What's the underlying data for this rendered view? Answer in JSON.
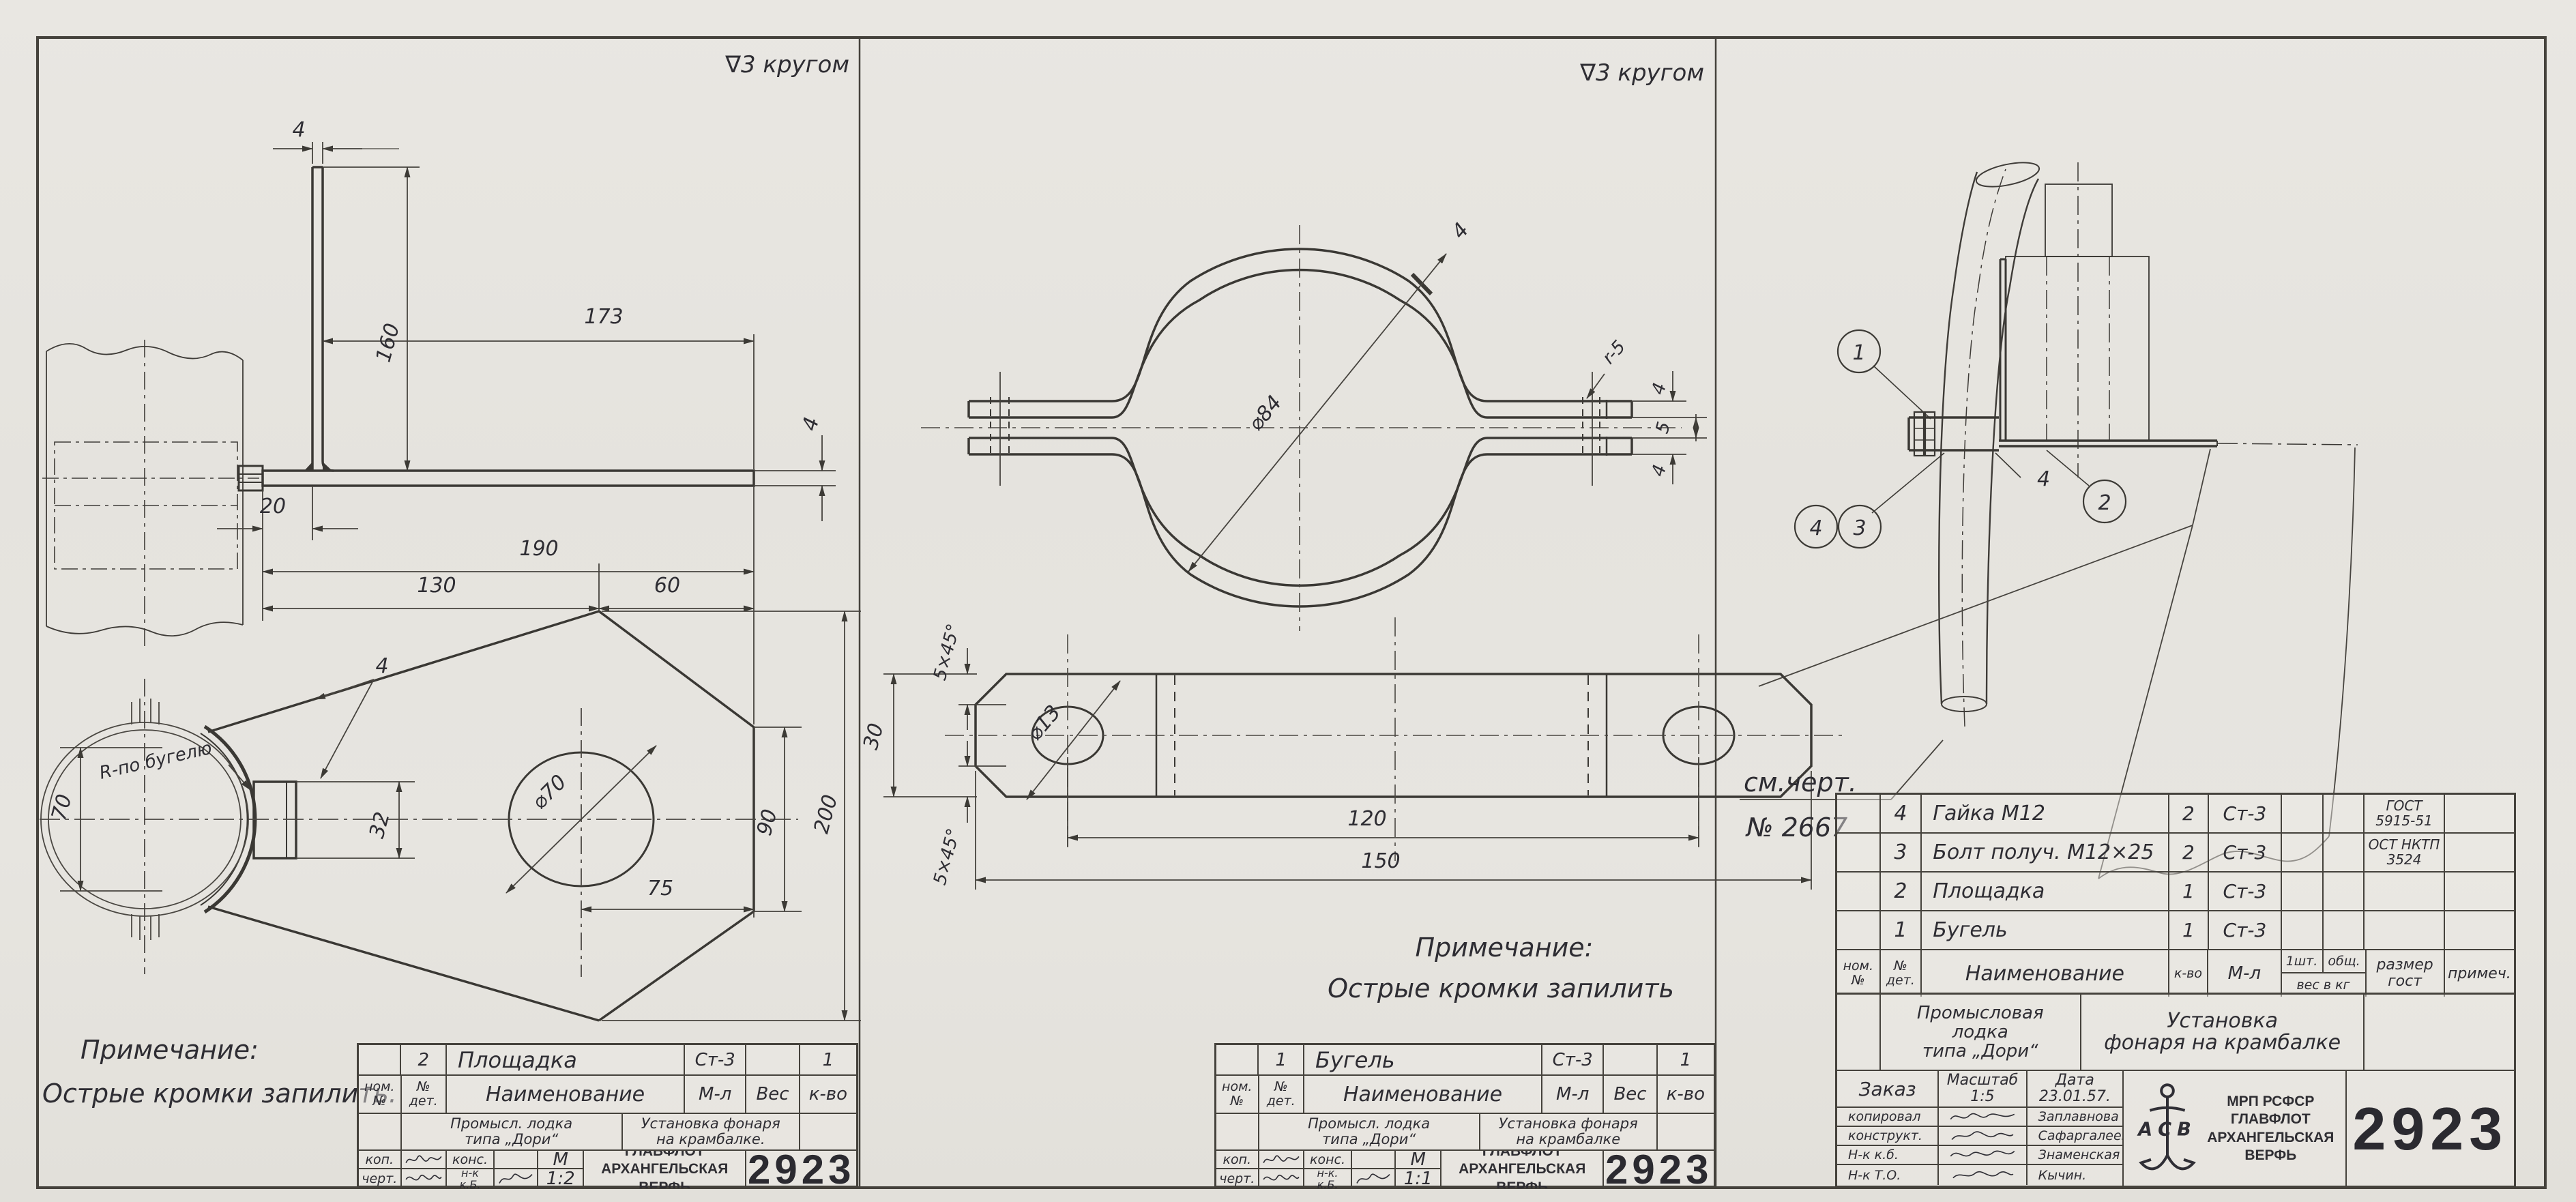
{
  "sheet": {
    "doc_number": "2923"
  },
  "panel_platform": {
    "surface_note": "∇3 кругом",
    "note_title": "Примечание:",
    "note_text": "Острые кромки запилить.",
    "dims": {
      "leg_thickness": "4",
      "leg_height": "160",
      "top_length": "173",
      "plate_thickness": "4",
      "end_offset": "20",
      "overall_length": "190",
      "split_left": "130",
      "split_right": "60",
      "pipe_width": "70",
      "radius_note": "R-по бугелю",
      "edge_callout": "4",
      "boss_height": "32",
      "hole_dia": "⌀70",
      "hole_offset": "75",
      "side_height": "90",
      "overall_height": "200"
    },
    "title_block": {
      "item_pos": "2",
      "item_name": "Площадка",
      "item_material": "Ст-3",
      "item_qty": "1",
      "h_pos": "ном.\n№",
      "h_det": "№\nдет.",
      "h_name": "Наименование",
      "h_mat": "М-л",
      "h_weight": "Вес",
      "h_qty": "к-во",
      "project": "Промысл. лодка\nтипа „Дори“",
      "title": "Установка фонаря\nна крамбалке.",
      "kop_label": "коп.",
      "kons_label": "конс.",
      "chert_label": "черт.",
      "nk_label": "н-к\nк.Б.",
      "m_label": "М",
      "scale": "1:2",
      "org": "ГЛАВФЛОТ\nАРХАНГЕЛЬСКАЯ\nВЕРФЬ",
      "number": "2923"
    }
  },
  "panel_clamp": {
    "surface_note": "∇3 кругом",
    "note_title": "Примечание:",
    "note_text": "Острые кромки запилить",
    "dims": {
      "dia": "⌀84",
      "band_thickness": "4",
      "fillet_radius": "r-5",
      "ear_top": "4",
      "ear_gap": "5",
      "ear_bottom": "4",
      "bar_width": "30",
      "chamfer_top": "5×45°",
      "chamfer_bottom": "5×45°",
      "hole_dia": "⌀13",
      "hole_spacing": "120",
      "bar_length": "150"
    },
    "title_block": {
      "item_pos": "1",
      "item_name": "Бугель",
      "item_material": "Ст-3",
      "item_qty": "1",
      "h_pos": "ном.\n№",
      "h_det": "№\nдет.",
      "h_name": "Наименование",
      "h_mat": "М-л",
      "h_weight": "Вес",
      "h_qty": "к-во",
      "project": "Промысл. лодка\nтипа „Дори“",
      "title": "Установка фонаря\nна крамбалке",
      "kop_label": "коп.",
      "kons_label": "конс.",
      "chert_label": "черт.",
      "nk_label": "н-к.\nк.Б.",
      "m_label": "М",
      "scale": "1:1",
      "org": "ГЛАВФЛОТ\nАРХАНГЕЛЬСКАЯ\nВЕРФЬ",
      "number": "2923"
    }
  },
  "panel_assembly": {
    "balloon_1": "1",
    "balloon_2": "2",
    "balloon_3": "3",
    "balloon_4": "4",
    "thickness_callout": "4",
    "ref_line1": "см.черт.",
    "ref_line2": "№ 2667",
    "parts_table": {
      "headers": {
        "pos": "ном.\n№",
        "det": "№\nдет.",
        "name": "Наименование",
        "qty": "к-во",
        "mat": "М-л",
        "per": "1шт.",
        "total": "общ.",
        "weight": "вес в кг",
        "size": "размер\nгост",
        "remark": "примеч."
      },
      "rows": [
        {
          "pos": "4",
          "name": "Гайка М12",
          "qty": "2",
          "material": "Ст-3",
          "standard": "ГОСТ\n5915-51"
        },
        {
          "pos": "3",
          "name": "Болт получ. М12×25",
          "qty": "2",
          "material": "Ст-3",
          "standard": "ОСТ НКТП\n3524"
        },
        {
          "pos": "2",
          "name": "Площадка",
          "qty": "1",
          "material": "Ст-3",
          "standard": ""
        },
        {
          "pos": "1",
          "name": "Бугель",
          "qty": "1",
          "material": "Ст-3",
          "standard": ""
        }
      ]
    },
    "title_block": {
      "project": "Промысловая\nлодка\nтипа „Дори“",
      "title": "Установка\nфонаря на крамбалке",
      "order_label": "Заказ",
      "scale": "Масштаб\n1:5",
      "date": "Дата\n23.01.57.",
      "roles": [
        {
          "role": "копировал",
          "name": "Заплавнова"
        },
        {
          "role": "конструкт.",
          "name": "Сафаргалеева"
        },
        {
          "role": "Н-к  к.б.",
          "name": "Знаменская"
        },
        {
          "role": "Н-к  Т.О.",
          "name": "Кычин."
        }
      ],
      "org": "МРП РСФСР\nГЛАВФЛОТ\nАРХАНГЕЛЬСКАЯ\nВЕРФЬ",
      "logo_letters": "АСВ",
      "number": "2923"
    }
  }
}
